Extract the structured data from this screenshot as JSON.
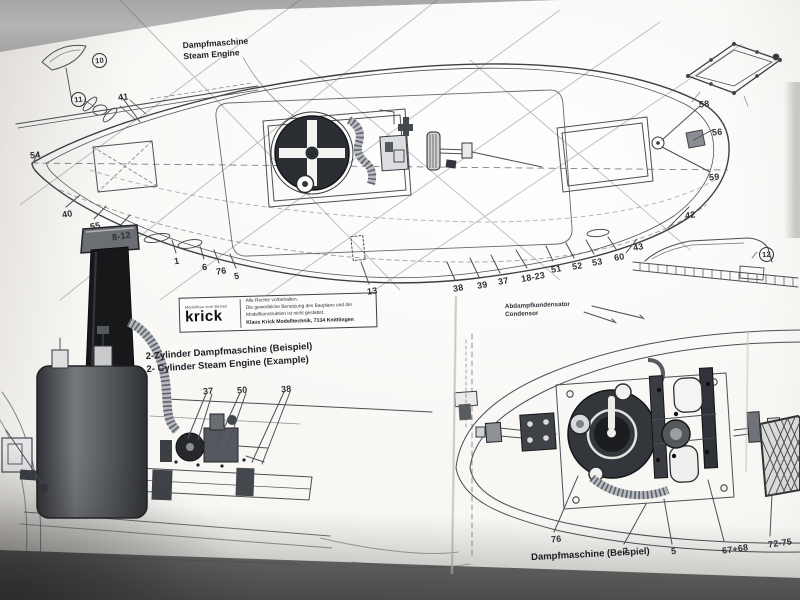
{
  "labels": {
    "steam_engine": {
      "de": "Dampfmaschine",
      "en": "Steam Engine"
    },
    "two_cyl": {
      "de": "2-Zylinder Dampfmaschine (Beispiel)",
      "en": "2- Cylinder Steam Engine (Example)"
    },
    "condenser": {
      "de": "Abdampfkondensator",
      "en": "Condensor"
    },
    "bottom_caption": "Dampfmaschine (Beispiel)"
  },
  "stamp": {
    "tagline": "Modellbau vom Besten",
    "brand": "krick",
    "line1": "Alle Rechte vorbehalten.",
    "line2": "Die gewerbliche Benutzung des Bauplans und der",
    "line3": "Modellkonstruktion ist nicht gestattet.",
    "line4": "Klaus Krick Modelltechnik, 7134 Knittlingen"
  },
  "part_labels": [
    {
      "t": "54",
      "x": 30,
      "y": 150,
      "r": -6
    },
    {
      "t": "41",
      "x": 118,
      "y": 92,
      "r": -6
    },
    {
      "t": "40",
      "x": 62,
      "y": 209,
      "r": -10
    },
    {
      "t": "55",
      "x": 90,
      "y": 221,
      "r": -10
    },
    {
      "t": "8-12",
      "x": 112,
      "y": 231,
      "r": -10
    },
    {
      "t": "1",
      "x": 174,
      "y": 256,
      "r": -8
    },
    {
      "t": "6",
      "x": 202,
      "y": 262,
      "r": -8
    },
    {
      "t": "76",
      "x": 216,
      "y": 266,
      "r": -8
    },
    {
      "t": "5",
      "x": 234,
      "y": 271,
      "r": -8
    },
    {
      "t": "13",
      "x": 367,
      "y": 286,
      "r": -8
    },
    {
      "t": "38",
      "x": 453,
      "y": 283,
      "r": -10
    },
    {
      "t": "39",
      "x": 477,
      "y": 280,
      "r": -10
    },
    {
      "t": "37",
      "x": 498,
      "y": 276,
      "r": -10
    },
    {
      "t": "18-23",
      "x": 521,
      "y": 272,
      "r": -10
    },
    {
      "t": "51",
      "x": 551,
      "y": 264,
      "r": -10
    },
    {
      "t": "52",
      "x": 572,
      "y": 261,
      "r": -10
    },
    {
      "t": "53",
      "x": 592,
      "y": 257,
      "r": -10
    },
    {
      "t": "60",
      "x": 614,
      "y": 252,
      "r": -10
    },
    {
      "t": "43",
      "x": 633,
      "y": 242,
      "r": -10
    },
    {
      "t": "42",
      "x": 685,
      "y": 210,
      "r": -8
    },
    {
      "t": "58",
      "x": 699,
      "y": 99,
      "r": -5
    },
    {
      "t": "56",
      "x": 712,
      "y": 127,
      "r": -5
    },
    {
      "t": "59",
      "x": 709,
      "y": 172,
      "r": -5
    },
    {
      "t": "37",
      "x": 203,
      "y": 386,
      "r": -4
    },
    {
      "t": "50",
      "x": 237,
      "y": 385,
      "r": -4
    },
    {
      "t": "38",
      "x": 281,
      "y": 384,
      "r": -4
    },
    {
      "t": "76",
      "x": 551,
      "y": 534,
      "r": -6
    },
    {
      "t": "7",
      "x": 623,
      "y": 546,
      "r": -6
    },
    {
      "t": "5",
      "x": 671,
      "y": 546,
      "r": -6
    },
    {
      "t": "67+68",
      "x": 722,
      "y": 544,
      "r": -8
    },
    {
      "t": "72-75",
      "x": 768,
      "y": 538,
      "r": -8
    }
  ],
  "circled_labels": [
    {
      "t": "10",
      "x": 92,
      "y": 53,
      "r": -5
    },
    {
      "t": "11",
      "x": 71,
      "y": 92,
      "r": -5
    },
    {
      "t": "12",
      "x": 759,
      "y": 247,
      "r": -4
    }
  ]
}
